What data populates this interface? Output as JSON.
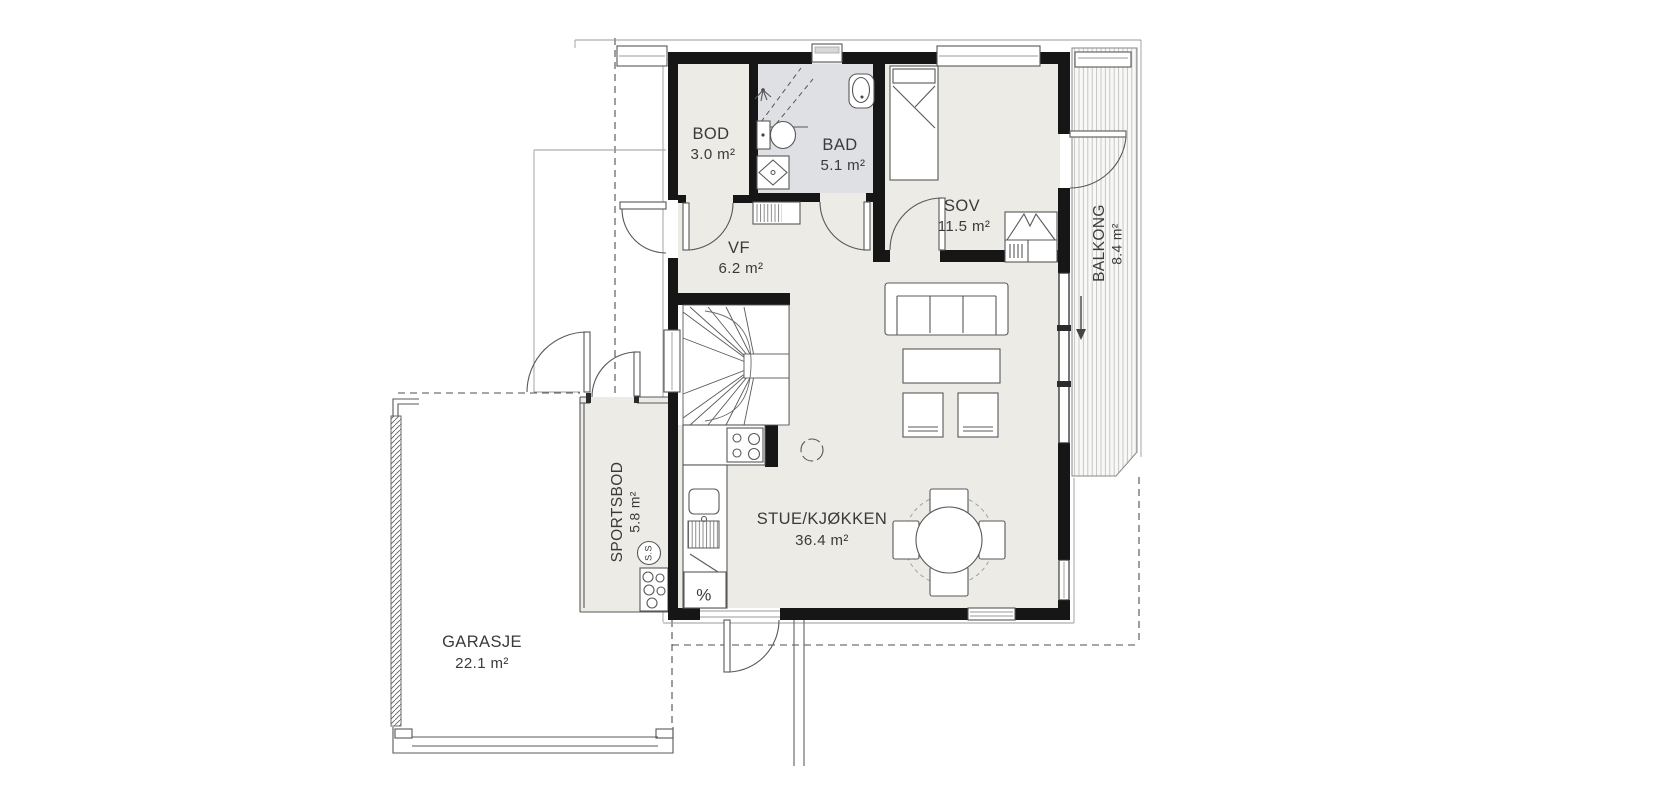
{
  "plan": {
    "title": "floor-plan",
    "colors": {
      "wall": "#161616",
      "floor": "#edebe6",
      "bathroom_floor": "#dfe0e3",
      "line": "#585858",
      "thin": "#9a9a9a",
      "text": "#3a3a3a",
      "deck_stripe": "#c2c2c0"
    },
    "rooms": [
      {
        "id": "bod",
        "name": "BOD",
        "area": "3.0 m²"
      },
      {
        "id": "bad",
        "name": "BAD",
        "area": "5.1 m²"
      },
      {
        "id": "sov",
        "name": "SOV",
        "area": "11.5 m²"
      },
      {
        "id": "vf",
        "name": "VF",
        "area": "6.2 m²"
      },
      {
        "id": "stue-kjokken",
        "name": "STUE/KJØKKEN",
        "area": "36.4 m²"
      },
      {
        "id": "balkong",
        "name": "BALKONG",
        "area": "8.4 m²"
      },
      {
        "id": "sportsbod",
        "name": "SPORTSBOD",
        "area": "5.8 m²"
      },
      {
        "id": "garasje",
        "name": "GARASJE",
        "area": "22.1 m²"
      }
    ],
    "annotations": {
      "tech_circle": "S.S",
      "fridge_symbol": "%"
    }
  }
}
